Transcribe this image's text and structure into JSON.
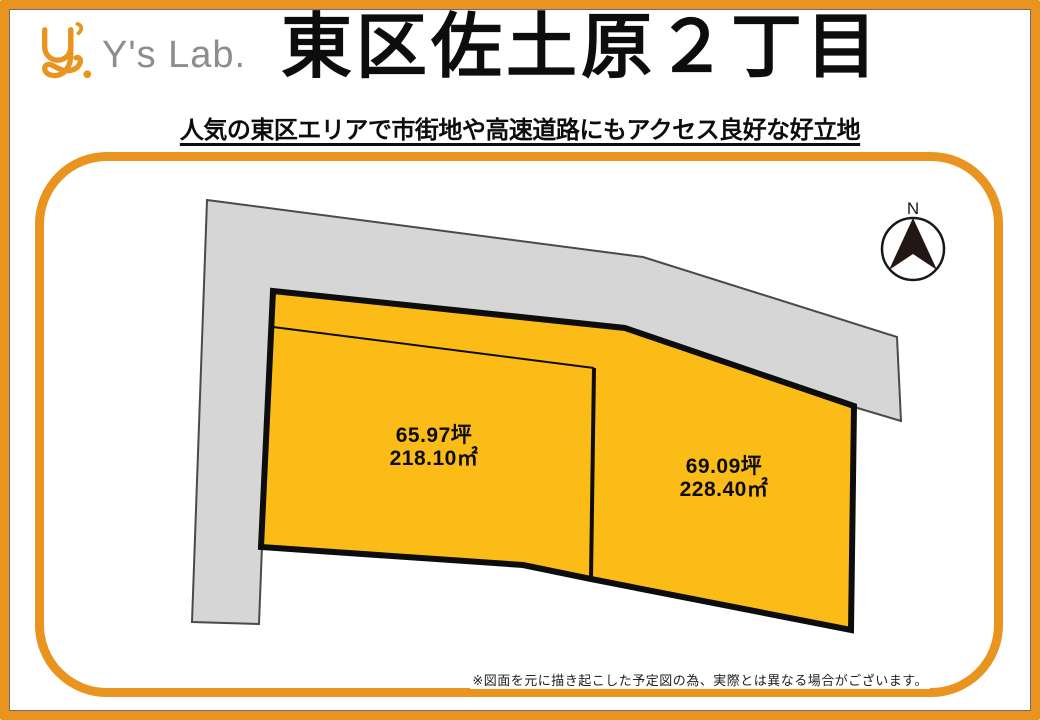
{
  "colors": {
    "orange": "#E8941E",
    "ink": "#0d0d0d",
    "plot_fill": "#FBBC17",
    "road_fill": "#D6D6D6",
    "road_stroke": "#4A4A4A",
    "brand_gray": "#8D8D8D",
    "compass_dark": "#221712"
  },
  "brand": {
    "name": "Y's Lab.",
    "logo_icon": "ys-monogram"
  },
  "header": {
    "title": "東区佐土原２丁目",
    "subtitle": "人気の東区エリアで市街地や高速道路にもアクセス良好な好立地"
  },
  "diagram": {
    "compass": {
      "label": "N"
    },
    "plots": [
      {
        "tsubo": "65.97坪",
        "area": "218.10㎡"
      },
      {
        "tsubo": "69.09坪",
        "area": "228.40㎡"
      }
    ]
  },
  "footer": {
    "disclaimer": "※図面を元に描き起こした予定図の為、実際とは異なる場合がございます。"
  }
}
